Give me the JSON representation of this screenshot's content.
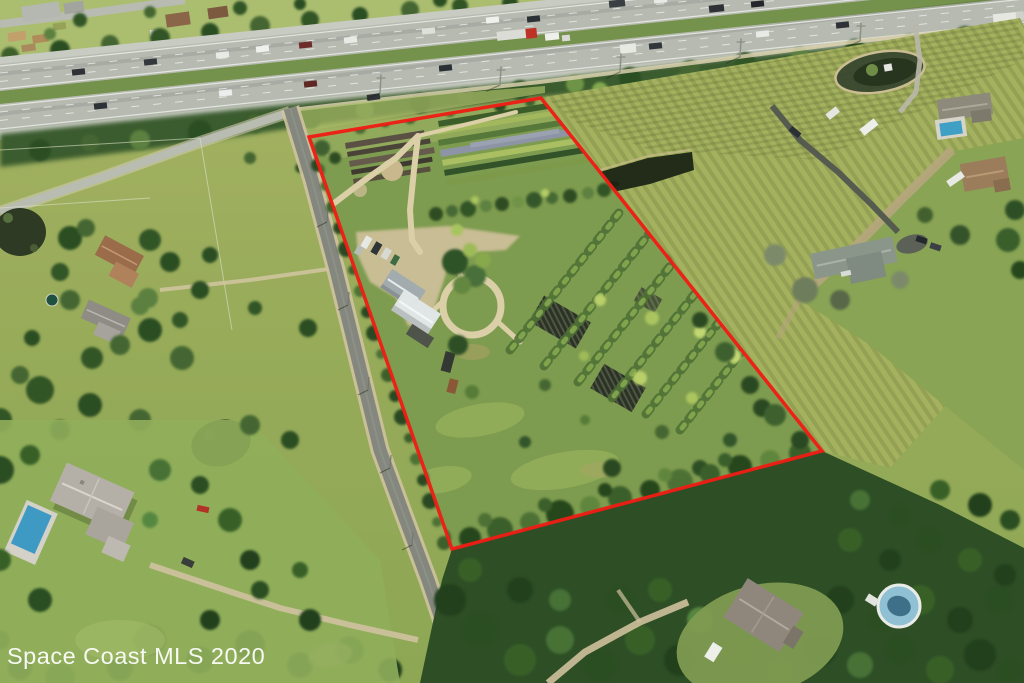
{
  "watermark": {
    "text": "Space Coast MLS 2020",
    "color": "#ffffff"
  },
  "overlay": {
    "boundary_color": "#ee1d15"
  },
  "scene": {
    "kind": "aerial-drone-photo",
    "features": [
      "interstate-highway-with-traffic",
      "red-property-boundary-outline",
      "plant-nursery-parcel",
      "canal-pond",
      "paved-side-road",
      "mowed-field",
      "residential-houses",
      "swimming-pools",
      "tree-forest"
    ]
  },
  "colors": {
    "water": "#222c19",
    "pool_blue": "#3e9ac3",
    "asphalt": "#84877e",
    "dirt_path": "#dbcfa8",
    "field_green": "#a4b15e",
    "forest_green": "#2e4e26"
  }
}
